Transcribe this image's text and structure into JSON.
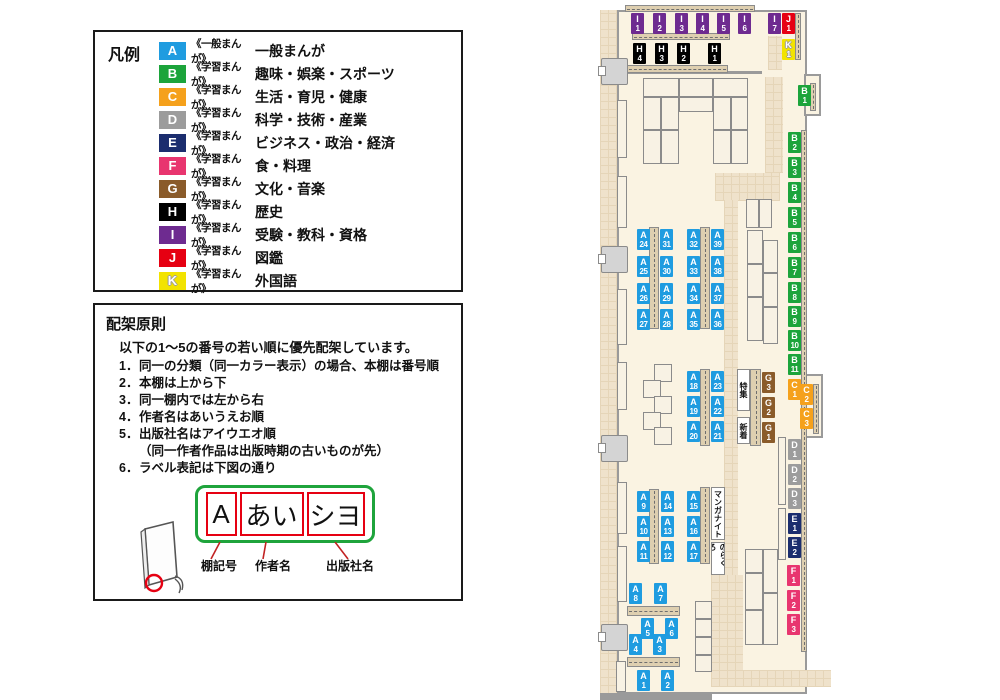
{
  "colors": {
    "A": "#1f9ce0",
    "B": "#1ca43b",
    "C": "#f5a11c",
    "D": "#9c9c9c",
    "E": "#1b2d6e",
    "F": "#e8356f",
    "G": "#8a5b2a",
    "H": "#000000",
    "I": "#6e2b90",
    "J": "#e60012",
    "K": "#f2e300"
  },
  "legend": {
    "title": "凡例",
    "items": [
      {
        "code": "A",
        "scope": "《一般まんが》",
        "label": "一般まんが"
      },
      {
        "code": "B",
        "scope": "《学習まんが》",
        "label": "趣味・娯楽・スポーツ"
      },
      {
        "code": "C",
        "scope": "《学習まんが》",
        "label": "生活・育児・健康"
      },
      {
        "code": "D",
        "scope": "《学習まんが》",
        "label": "科学・技術・産業"
      },
      {
        "code": "E",
        "scope": "《学習まんが》",
        "label": "ビジネス・政治・経済"
      },
      {
        "code": "F",
        "scope": "《学習まんが》",
        "label": "食・料理"
      },
      {
        "code": "G",
        "scope": "《学習まんが》",
        "label": "文化・音楽"
      },
      {
        "code": "H",
        "scope": "《学習まんが》",
        "label": "歴史"
      },
      {
        "code": "I",
        "scope": "《学習まんが》",
        "label": "受験・教科・資格"
      },
      {
        "code": "J",
        "scope": "《学習まんが》",
        "label": "図鑑"
      },
      {
        "code": "K",
        "scope": "《学習まんが》",
        "label": "外国語"
      }
    ]
  },
  "principles": {
    "title": "配架原則",
    "intro": "以下の1～5の番号の若い順に優先配架しています。",
    "rules": [
      {
        "num": "1．",
        "text": "同一の分類（同一カラー表示）の場合、本棚は番号順"
      },
      {
        "num": "2．",
        "text": "本棚は上から下"
      },
      {
        "num": "3．",
        "text": "同一棚内では左から右"
      },
      {
        "num": "4．",
        "text": "作者名はあいうえお順"
      },
      {
        "num": "5．",
        "text": "出版社名はアイウエオ順",
        "text2": "（同一作者作品は出版時期の古いものが先）"
      },
      {
        "num": "6．",
        "text": "ラベル表記は下図の通り"
      }
    ],
    "diagram": {
      "shelf_code": "A",
      "author": "あい",
      "publisher": "シヨ",
      "captions": [
        "棚記号",
        "作者名",
        "出版社名"
      ]
    }
  },
  "map": {
    "shelf_labels": [
      {
        "c": "I",
        "n": "1",
        "x": 631,
        "y": 13
      },
      {
        "c": "I",
        "n": "2",
        "x": 653,
        "y": 13
      },
      {
        "c": "I",
        "n": "3",
        "x": 675,
        "y": 13
      },
      {
        "c": "I",
        "n": "4",
        "x": 696,
        "y": 13
      },
      {
        "c": "I",
        "n": "5",
        "x": 717,
        "y": 13
      },
      {
        "c": "I",
        "n": "6",
        "x": 738,
        "y": 13
      },
      {
        "c": "I",
        "n": "7",
        "x": 768,
        "y": 13
      },
      {
        "c": "J",
        "n": "1",
        "x": 782,
        "y": 13
      },
      {
        "c": "K",
        "n": "1",
        "x": 782,
        "y": 39
      },
      {
        "c": "H",
        "n": "4",
        "x": 633,
        "y": 43
      },
      {
        "c": "H",
        "n": "3",
        "x": 655,
        "y": 43
      },
      {
        "c": "H",
        "n": "2",
        "x": 677,
        "y": 43
      },
      {
        "c": "H",
        "n": "1",
        "x": 708,
        "y": 43
      },
      {
        "c": "B",
        "n": "1",
        "x": 798,
        "y": 85
      },
      {
        "c": "B",
        "n": "2",
        "x": 788,
        "y": 132
      },
      {
        "c": "B",
        "n": "3",
        "x": 788,
        "y": 157
      },
      {
        "c": "B",
        "n": "4",
        "x": 788,
        "y": 182
      },
      {
        "c": "B",
        "n": "5",
        "x": 788,
        "y": 207
      },
      {
        "c": "B",
        "n": "6",
        "x": 788,
        "y": 232
      },
      {
        "c": "B",
        "n": "7",
        "x": 788,
        "y": 257
      },
      {
        "c": "B",
        "n": "8",
        "x": 788,
        "y": 282
      },
      {
        "c": "B",
        "n": "9",
        "x": 788,
        "y": 306
      },
      {
        "c": "B",
        "n": "10",
        "x": 788,
        "y": 330
      },
      {
        "c": "B",
        "n": "11",
        "x": 788,
        "y": 354
      },
      {
        "c": "C",
        "n": "1",
        "x": 788,
        "y": 379
      },
      {
        "c": "C",
        "n": "2",
        "x": 800,
        "y": 384
      },
      {
        "c": "C",
        "n": "3",
        "x": 800,
        "y": 408
      },
      {
        "c": "D",
        "n": "1",
        "x": 788,
        "y": 439
      },
      {
        "c": "D",
        "n": "2",
        "x": 788,
        "y": 464
      },
      {
        "c": "D",
        "n": "3",
        "x": 788,
        "y": 488
      },
      {
        "c": "E",
        "n": "1",
        "x": 788,
        "y": 513
      },
      {
        "c": "E",
        "n": "2",
        "x": 788,
        "y": 537
      },
      {
        "c": "F",
        "n": "1",
        "x": 787,
        "y": 565
      },
      {
        "c": "F",
        "n": "2",
        "x": 787,
        "y": 590
      },
      {
        "c": "F",
        "n": "3",
        "x": 787,
        "y": 614
      },
      {
        "c": "A",
        "n": "24",
        "x": 637,
        "y": 229
      },
      {
        "c": "A",
        "n": "31",
        "x": 660,
        "y": 229
      },
      {
        "c": "A",
        "n": "25",
        "x": 637,
        "y": 256
      },
      {
        "c": "A",
        "n": "30",
        "x": 660,
        "y": 256
      },
      {
        "c": "A",
        "n": "26",
        "x": 637,
        "y": 283
      },
      {
        "c": "A",
        "n": "29",
        "x": 660,
        "y": 283
      },
      {
        "c": "A",
        "n": "27",
        "x": 637,
        "y": 309
      },
      {
        "c": "A",
        "n": "28",
        "x": 660,
        "y": 309
      },
      {
        "c": "A",
        "n": "32",
        "x": 687,
        "y": 229
      },
      {
        "c": "A",
        "n": "39",
        "x": 711,
        "y": 229
      },
      {
        "c": "A",
        "n": "33",
        "x": 687,
        "y": 256
      },
      {
        "c": "A",
        "n": "38",
        "x": 711,
        "y": 256
      },
      {
        "c": "A",
        "n": "34",
        "x": 687,
        "y": 283
      },
      {
        "c": "A",
        "n": "37",
        "x": 711,
        "y": 283
      },
      {
        "c": "A",
        "n": "35",
        "x": 687,
        "y": 309
      },
      {
        "c": "A",
        "n": "36",
        "x": 711,
        "y": 309
      },
      {
        "c": "A",
        "n": "18",
        "x": 687,
        "y": 371
      },
      {
        "c": "A",
        "n": "23",
        "x": 711,
        "y": 371
      },
      {
        "c": "A",
        "n": "19",
        "x": 687,
        "y": 396
      },
      {
        "c": "A",
        "n": "22",
        "x": 711,
        "y": 396
      },
      {
        "c": "A",
        "n": "20",
        "x": 687,
        "y": 421
      },
      {
        "c": "A",
        "n": "21",
        "x": 711,
        "y": 421
      },
      {
        "c": "G",
        "n": "3",
        "x": 762,
        "y": 372
      },
      {
        "c": "G",
        "n": "2",
        "x": 762,
        "y": 397
      },
      {
        "c": "G",
        "n": "1",
        "x": 762,
        "y": 422
      },
      {
        "c": "A",
        "n": "9",
        "x": 637,
        "y": 491
      },
      {
        "c": "A",
        "n": "14",
        "x": 661,
        "y": 491
      },
      {
        "c": "A",
        "n": "10",
        "x": 637,
        "y": 516
      },
      {
        "c": "A",
        "n": "13",
        "x": 661,
        "y": 516
      },
      {
        "c": "A",
        "n": "11",
        "x": 637,
        "y": 541
      },
      {
        "c": "A",
        "n": "12",
        "x": 661,
        "y": 541
      },
      {
        "c": "A",
        "n": "15",
        "x": 687,
        "y": 491
      },
      {
        "c": "A",
        "n": "16",
        "x": 687,
        "y": 516
      },
      {
        "c": "A",
        "n": "17",
        "x": 687,
        "y": 541
      },
      {
        "c": "A",
        "n": "8",
        "x": 629,
        "y": 583
      },
      {
        "c": "A",
        "n": "7",
        "x": 654,
        "y": 583
      },
      {
        "c": "A",
        "n": "5",
        "x": 641,
        "y": 618
      },
      {
        "c": "A",
        "n": "6",
        "x": 665,
        "y": 618
      },
      {
        "c": "A",
        "n": "4",
        "x": 629,
        "y": 634
      },
      {
        "c": "A",
        "n": "3",
        "x": 653,
        "y": 634
      },
      {
        "c": "A",
        "n": "1",
        "x": 637,
        "y": 670
      },
      {
        "c": "A",
        "n": "2",
        "x": 661,
        "y": 670
      }
    ],
    "area_labels": [
      {
        "text": "特集",
        "x": 737,
        "y": 369,
        "w": 13,
        "h": 42
      },
      {
        "text": "新着",
        "x": 737,
        "y": 417,
        "w": 13,
        "h": 27
      },
      {
        "text": "マンガナイト",
        "x": 711,
        "y": 487,
        "w": 14,
        "h": 53
      },
      {
        "text": "のらくろ",
        "x": 711,
        "y": 542,
        "w": 14,
        "h": 33
      }
    ]
  }
}
